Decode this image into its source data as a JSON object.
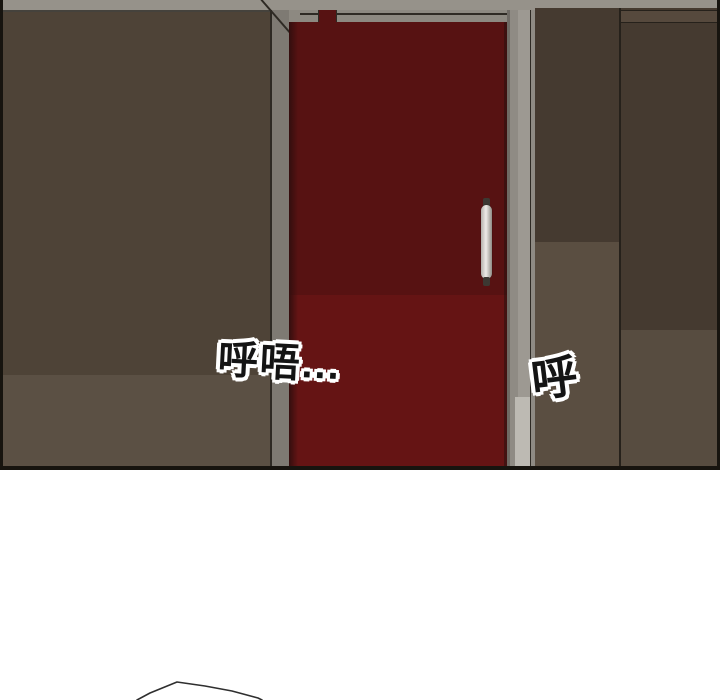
{
  "scene": {
    "description": "comic panel: hallway interior with closed red door",
    "sfx_left": "呼唔...",
    "sfx_right": "呼"
  },
  "colors": {
    "page_bg": "#ffffff",
    "panel_border": "#17140f",
    "ceiling": "#96928a",
    "ceiling_line": "#45423c",
    "wall_left_upper": "#4e4337",
    "wall_left_lower": "#5b5044",
    "jamb_gray": "#7e7a73",
    "jamb_dark_line": "#2e2a24",
    "lintel_gray": "#8d8981",
    "door_red_upper": "#571212",
    "door_red_lower": "#651414",
    "door_edge_dark": "#330e0e",
    "jamb_strip_light": "#9d9992",
    "jamb_strip_mid": "#8f8b84",
    "jamb_strip_dark": "#6e6a64",
    "jamb_strip_pale": "#bdbab3",
    "wall_right_dark": "#453a30",
    "wall_right_mid_lower": "#5a4e41",
    "wall_right_far_lower": "#574c40",
    "divider_dark": "#26211b",
    "handle_light": "#eeece8",
    "handle_mid": "#b3b0aa",
    "handle_dark": "#3c3832",
    "sfx_fill": "#141414",
    "sfx_outline": "#ffffff",
    "sketch_stroke": "#2f2f2f"
  }
}
